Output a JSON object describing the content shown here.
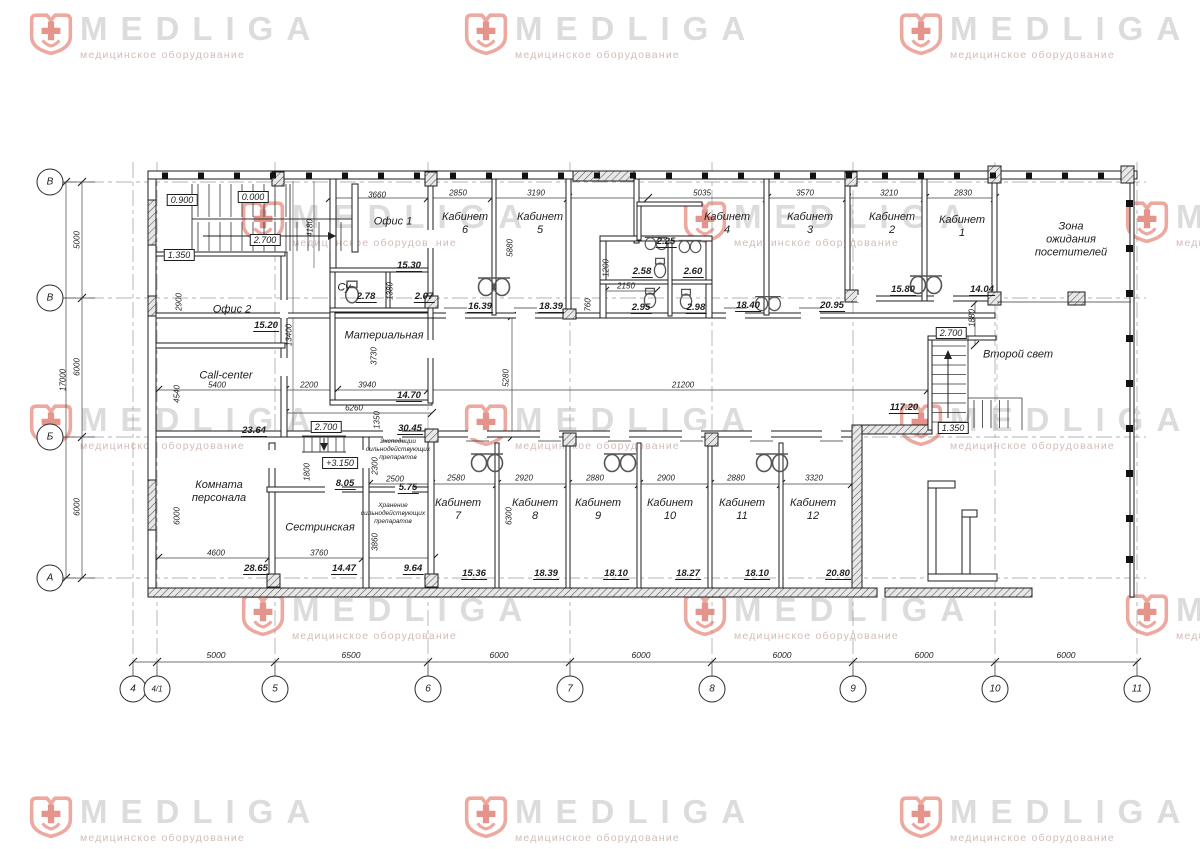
{
  "watermark": {
    "brand": "MEDLIGA",
    "subtitle": "медицинское оборудование",
    "logo_color": "#eda89f",
    "cross_color": "#e4948a",
    "text_color": "#dcdcdc",
    "subtitle_color": "#d2bcb8",
    "positions": [
      {
        "x": 28,
        "y": 12
      },
      {
        "x": 463,
        "y": 12
      },
      {
        "x": 898,
        "y": 12
      },
      {
        "x": -315,
        "y": 200
      },
      {
        "x": 240,
        "y": 200
      },
      {
        "x": 682,
        "y": 200
      },
      {
        "x": 1124,
        "y": 200
      },
      {
        "x": 28,
        "y": 403
      },
      {
        "x": 463,
        "y": 403
      },
      {
        "x": 898,
        "y": 403
      },
      {
        "x": -315,
        "y": 593
      },
      {
        "x": 240,
        "y": 593
      },
      {
        "x": 682,
        "y": 593
      },
      {
        "x": 1124,
        "y": 593
      },
      {
        "x": 28,
        "y": 795
      },
      {
        "x": 463,
        "y": 795
      },
      {
        "x": 898,
        "y": 795
      }
    ]
  },
  "plan": {
    "labels": [
      {
        "c": "rn",
        "t": "Офис 1",
        "x": 393,
        "y": 222
      },
      {
        "c": "rn",
        "t": "Офис 2",
        "x": 232,
        "y": 310
      },
      {
        "c": "rn",
        "t": "Кабинет\n6",
        "x": 465,
        "y": 224
      },
      {
        "c": "rn",
        "t": "Кабинет\n5",
        "x": 540,
        "y": 224
      },
      {
        "c": "rn",
        "t": "Кабинет\n4",
        "x": 727,
        "y": 224
      },
      {
        "c": "rn",
        "t": "Кабинет\n3",
        "x": 810,
        "y": 224
      },
      {
        "c": "rn",
        "t": "Кабинет\n2",
        "x": 892,
        "y": 224
      },
      {
        "c": "rn",
        "t": "Кабинет\n1",
        "x": 962,
        "y": 227
      },
      {
        "c": "rn",
        "t": "Зона\nожидания\nпосетителей",
        "x": 1071,
        "y": 240
      },
      {
        "c": "rn",
        "t": "Су",
        "x": 344,
        "y": 288
      },
      {
        "c": "rn",
        "t": "Материальная",
        "x": 384,
        "y": 336
      },
      {
        "c": "rn",
        "t": "Call-center",
        "x": 226,
        "y": 376
      },
      {
        "c": "rn",
        "t": "Комната\nперсонала",
        "x": 219,
        "y": 492
      },
      {
        "c": "rn",
        "t": "Сестринская",
        "x": 320,
        "y": 528
      },
      {
        "c": "rn",
        "t": "Кабинет\n7",
        "x": 458,
        "y": 510
      },
      {
        "c": "rn",
        "t": "Кабинет\n8",
        "x": 535,
        "y": 510
      },
      {
        "c": "rn",
        "t": "Кабинет\n9",
        "x": 598,
        "y": 510
      },
      {
        "c": "rn",
        "t": "Кабинет\n10",
        "x": 670,
        "y": 510
      },
      {
        "c": "rn",
        "t": "Кабинет\n11",
        "x": 742,
        "y": 510
      },
      {
        "c": "rn",
        "t": "Кабинет\n12",
        "x": 813,
        "y": 510
      },
      {
        "c": "rn",
        "t": "Второй свет",
        "x": 1018,
        "y": 355
      },
      {
        "c": "rns",
        "t": "Экспедиции\nсильнодействующих\nпрепаратов",
        "x": 398,
        "y": 450
      },
      {
        "c": "rns",
        "t": "Хранение\nсильнодействующих\nпрепаратов",
        "x": 393,
        "y": 514
      },
      {
        "c": "ar",
        "t": "15.30",
        "x": 409,
        "y": 266
      },
      {
        "c": "ar",
        "t": "16.39",
        "x": 480,
        "y": 307
      },
      {
        "c": "ar",
        "t": "18.39",
        "x": 551,
        "y": 307
      },
      {
        "c": "ar",
        "t": "18.40",
        "x": 748,
        "y": 306
      },
      {
        "c": "ar",
        "t": "20.95",
        "x": 832,
        "y": 306
      },
      {
        "c": "ar",
        "t": "15.80",
        "x": 903,
        "y": 290
      },
      {
        "c": "ar",
        "t": "14.04",
        "x": 982,
        "y": 290
      },
      {
        "c": "ar",
        "t": "15.20",
        "x": 266,
        "y": 326
      },
      {
        "c": "ar",
        "t": "2.78",
        "x": 366,
        "y": 297
      },
      {
        "c": "ar",
        "t": "2.07",
        "x": 424,
        "y": 297
      },
      {
        "c": "ar",
        "t": "2.25",
        "x": 666,
        "y": 242
      },
      {
        "c": "ar",
        "t": "2.58",
        "x": 642,
        "y": 272
      },
      {
        "c": "ar",
        "t": "2.60",
        "x": 693,
        "y": 272
      },
      {
        "c": "ar",
        "t": "2.95",
        "x": 641,
        "y": 308
      },
      {
        "c": "ar",
        "t": "2.98",
        "x": 696,
        "y": 308
      },
      {
        "c": "ar",
        "t": "14.70",
        "x": 409,
        "y": 396
      },
      {
        "c": "ar",
        "t": "23.64",
        "x": 254,
        "y": 431
      },
      {
        "c": "ar",
        "t": "30.45",
        "x": 410,
        "y": 429
      },
      {
        "c": "ar",
        "t": "117.20",
        "x": 904,
        "y": 408
      },
      {
        "c": "ar",
        "t": "8.05",
        "x": 345,
        "y": 484
      },
      {
        "c": "ar",
        "t": "5.75",
        "x": 408,
        "y": 488
      },
      {
        "c": "ar",
        "t": "28.65",
        "x": 256,
        "y": 569
      },
      {
        "c": "ar",
        "t": "14.47",
        "x": 344,
        "y": 569
      },
      {
        "c": "ar",
        "t": "9.64",
        "x": 413,
        "y": 569
      },
      {
        "c": "ar",
        "t": "15.36",
        "x": 474,
        "y": 574
      },
      {
        "c": "ar",
        "t": "18.39",
        "x": 546,
        "y": 574
      },
      {
        "c": "ar",
        "t": "18.10",
        "x": 616,
        "y": 574
      },
      {
        "c": "ar",
        "t": "18.27",
        "x": 688,
        "y": 574
      },
      {
        "c": "ar",
        "t": "18.10",
        "x": 757,
        "y": 574
      },
      {
        "c": "ar",
        "t": "20.80",
        "x": 838,
        "y": 574
      },
      {
        "c": "el",
        "t": "0.900",
        "x": 182,
        "y": 200
      },
      {
        "c": "el",
        "t": "0.000",
        "x": 253,
        "y": 197
      },
      {
        "c": "el",
        "t": "2.700",
        "x": 265,
        "y": 240
      },
      {
        "c": "el",
        "t": "1.350",
        "x": 179,
        "y": 255
      },
      {
        "c": "el",
        "t": "2.700",
        "x": 326,
        "y": 427
      },
      {
        "c": "el",
        "t": "+3.150",
        "x": 340,
        "y": 463
      },
      {
        "c": "el",
        "t": "2.700",
        "x": 951,
        "y": 333
      },
      {
        "c": "el",
        "t": "1.350",
        "x": 953,
        "y": 428
      },
      {
        "c": "dh",
        "t": "3660",
        "x": 377,
        "y": 195
      },
      {
        "c": "dh",
        "t": "2850",
        "x": 458,
        "y": 193
      },
      {
        "c": "dh",
        "t": "3190",
        "x": 536,
        "y": 193
      },
      {
        "c": "dh",
        "t": "5035",
        "x": 702,
        "y": 193
      },
      {
        "c": "dh",
        "t": "3570",
        "x": 805,
        "y": 193
      },
      {
        "c": "dh",
        "t": "3210",
        "x": 889,
        "y": 193
      },
      {
        "c": "dh",
        "t": "2830",
        "x": 963,
        "y": 193
      },
      {
        "c": "dh",
        "t": "2150",
        "x": 626,
        "y": 286
      },
      {
        "c": "dh",
        "t": "5400",
        "x": 217,
        "y": 385
      },
      {
        "c": "dh",
        "t": "2200",
        "x": 309,
        "y": 385
      },
      {
        "c": "dh",
        "t": "3940",
        "x": 367,
        "y": 385
      },
      {
        "c": "dh",
        "t": "6260",
        "x": 354,
        "y": 408
      },
      {
        "c": "dh",
        "t": "21200",
        "x": 683,
        "y": 385
      },
      {
        "c": "dh",
        "t": "4600",
        "x": 216,
        "y": 553
      },
      {
        "c": "dh",
        "t": "3760",
        "x": 319,
        "y": 553
      },
      {
        "c": "dh",
        "t": "2500",
        "x": 395,
        "y": 479
      },
      {
        "c": "dh",
        "t": "2580",
        "x": 456,
        "y": 478
      },
      {
        "c": "dh",
        "t": "2920",
        "x": 524,
        "y": 478
      },
      {
        "c": "dh",
        "t": "2880",
        "x": 595,
        "y": 478
      },
      {
        "c": "dh",
        "t": "2900",
        "x": 666,
        "y": 478
      },
      {
        "c": "dh",
        "t": "2880",
        "x": 736,
        "y": 478
      },
      {
        "c": "dh",
        "t": "3320",
        "x": 814,
        "y": 478
      },
      {
        "c": "dhb",
        "t": "5000",
        "x": 216,
        "y": 655
      },
      {
        "c": "dhb",
        "t": "6500",
        "x": 351,
        "y": 655
      },
      {
        "c": "dhb",
        "t": "6000",
        "x": 499,
        "y": 655
      },
      {
        "c": "dhb",
        "t": "6000",
        "x": 641,
        "y": 655
      },
      {
        "c": "dhb",
        "t": "6000",
        "x": 782,
        "y": 655
      },
      {
        "c": "dhb",
        "t": "6000",
        "x": 924,
        "y": 655
      },
      {
        "c": "dhb",
        "t": "6000",
        "x": 1066,
        "y": 655
      },
      {
        "c": "dv",
        "t": "5000",
        "x": 77,
        "y": 240
      },
      {
        "c": "dv",
        "t": "6000",
        "x": 77,
        "y": 367
      },
      {
        "c": "dv",
        "t": "6000",
        "x": 77,
        "y": 507
      },
      {
        "c": "dv",
        "t": "17000",
        "x": 63,
        "y": 380
      },
      {
        "c": "dv",
        "t": "2900",
        "x": 179,
        "y": 302
      },
      {
        "c": "dv",
        "t": "13400",
        "x": 289,
        "y": 335
      },
      {
        "c": "dv",
        "t": "4180",
        "x": 310,
        "y": 228
      },
      {
        "c": "dv",
        "t": "1380",
        "x": 390,
        "y": 291
      },
      {
        "c": "dv",
        "t": "3730",
        "x": 374,
        "y": 356
      },
      {
        "c": "dv",
        "t": "5880",
        "x": 510,
        "y": 248
      },
      {
        "c": "dv",
        "t": "1200",
        "x": 606,
        "y": 268
      },
      {
        "c": "dv",
        "t": "760",
        "x": 588,
        "y": 305
      },
      {
        "c": "dv",
        "t": "5280",
        "x": 506,
        "y": 378
      },
      {
        "c": "dv",
        "t": "1350",
        "x": 377,
        "y": 420
      },
      {
        "c": "dv",
        "t": "4540",
        "x": 177,
        "y": 394
      },
      {
        "c": "dv",
        "t": "1800",
        "x": 307,
        "y": 472
      },
      {
        "c": "dv",
        "t": "2300",
        "x": 375,
        "y": 466
      },
      {
        "c": "dv",
        "t": "3860",
        "x": 375,
        "y": 542
      },
      {
        "c": "dv",
        "t": "6000",
        "x": 177,
        "y": 516
      },
      {
        "c": "dv",
        "t": "6300",
        "x": 509,
        "y": 516
      },
      {
        "c": "dv",
        "t": "1880",
        "x": 972,
        "y": 318
      },
      {
        "c": "axb",
        "t": "4",
        "x": 133,
        "y": 689
      },
      {
        "c": "axb",
        "t": "4/1",
        "x": 157,
        "y": 689
      },
      {
        "c": "axb",
        "t": "5",
        "x": 275,
        "y": 689
      },
      {
        "c": "axb",
        "t": "6",
        "x": 428,
        "y": 689
      },
      {
        "c": "axb",
        "t": "7",
        "x": 570,
        "y": 689
      },
      {
        "c": "axb",
        "t": "8",
        "x": 712,
        "y": 689
      },
      {
        "c": "axb",
        "t": "9",
        "x": 853,
        "y": 689
      },
      {
        "c": "axb",
        "t": "10",
        "x": 995,
        "y": 689
      },
      {
        "c": "axb",
        "t": "11",
        "x": 1137,
        "y": 689
      },
      {
        "c": "axl",
        "t": "В",
        "x": 50,
        "y": 182
      },
      {
        "c": "axl",
        "t": "В",
        "x": 50,
        "y": 298
      },
      {
        "c": "axl",
        "t": "Б",
        "x": 50,
        "y": 437
      },
      {
        "c": "axl",
        "t": "А",
        "x": 50,
        "y": 578
      }
    ]
  }
}
